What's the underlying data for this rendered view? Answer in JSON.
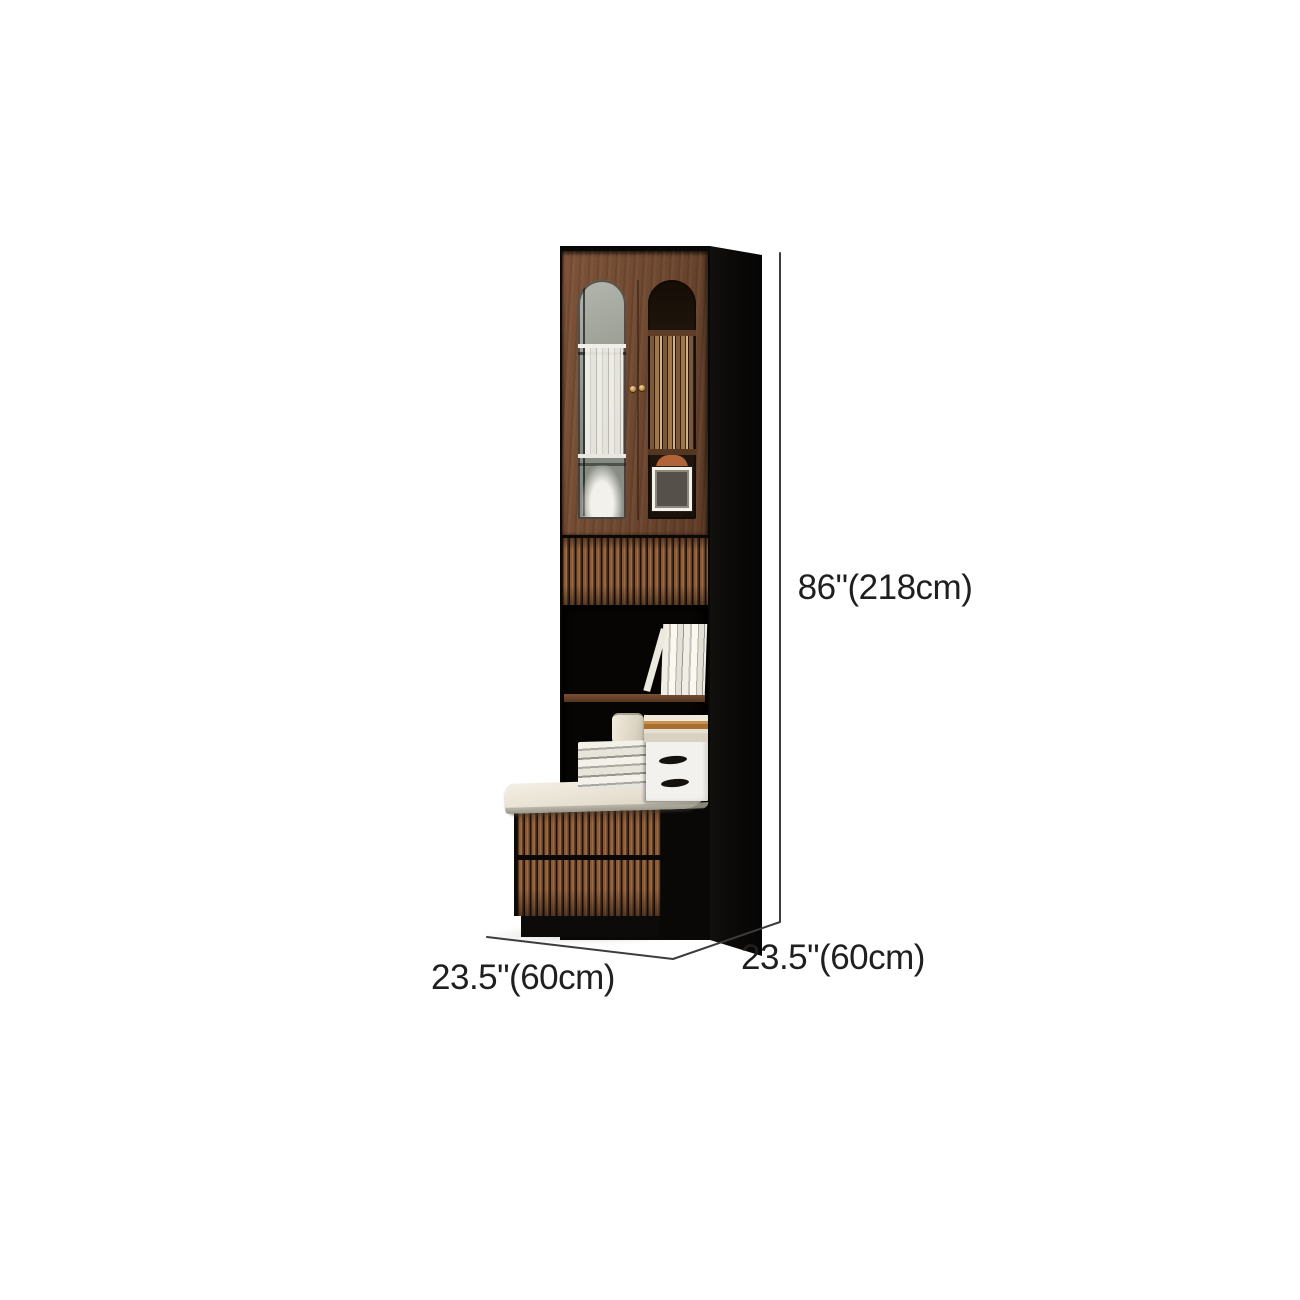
{
  "image": {
    "name": "bookcase-with-storage-bench-product-photo",
    "background": "#ffffff"
  },
  "dimensions": {
    "height_label": "86\"(218cm)",
    "depth_label": "23.5\"(60cm)",
    "width_label": "23.5\"(60cm)"
  },
  "colors": {
    "wood_brown": "#6e4830",
    "slat_brown": "#8a5a38",
    "frame_black": "#0b0a08",
    "cushion_cream": "#ece5d8",
    "knob_gold": "#c9a35c",
    "dimension_line": "#3c3c3c",
    "label_text": "#1f1f1f"
  }
}
